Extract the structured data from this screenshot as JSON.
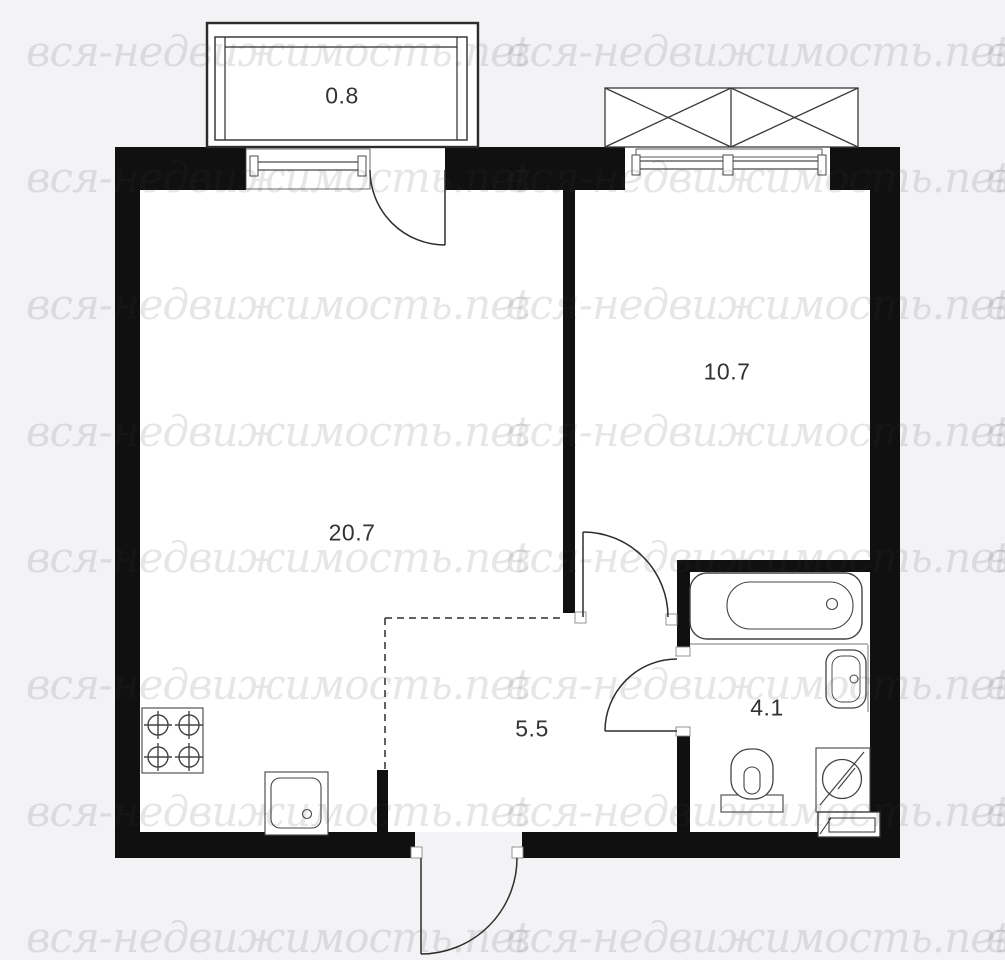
{
  "watermark": {
    "text": "вся-недвижимость.net",
    "color": "rgba(60,60,60,0.13)"
  },
  "rooms": [
    {
      "name": "balcony",
      "area": "0.8"
    },
    {
      "name": "living-kitchen",
      "area": "20.7"
    },
    {
      "name": "bedroom",
      "area": "10.7"
    },
    {
      "name": "hallway",
      "area": "5.5"
    },
    {
      "name": "bathroom",
      "area": "4.1"
    }
  ],
  "colors": {
    "background": "#f3f3f5",
    "wall": "#101010",
    "room_fill": "#ffffff",
    "line": "#3a3a3a",
    "label_text": "#333333"
  }
}
